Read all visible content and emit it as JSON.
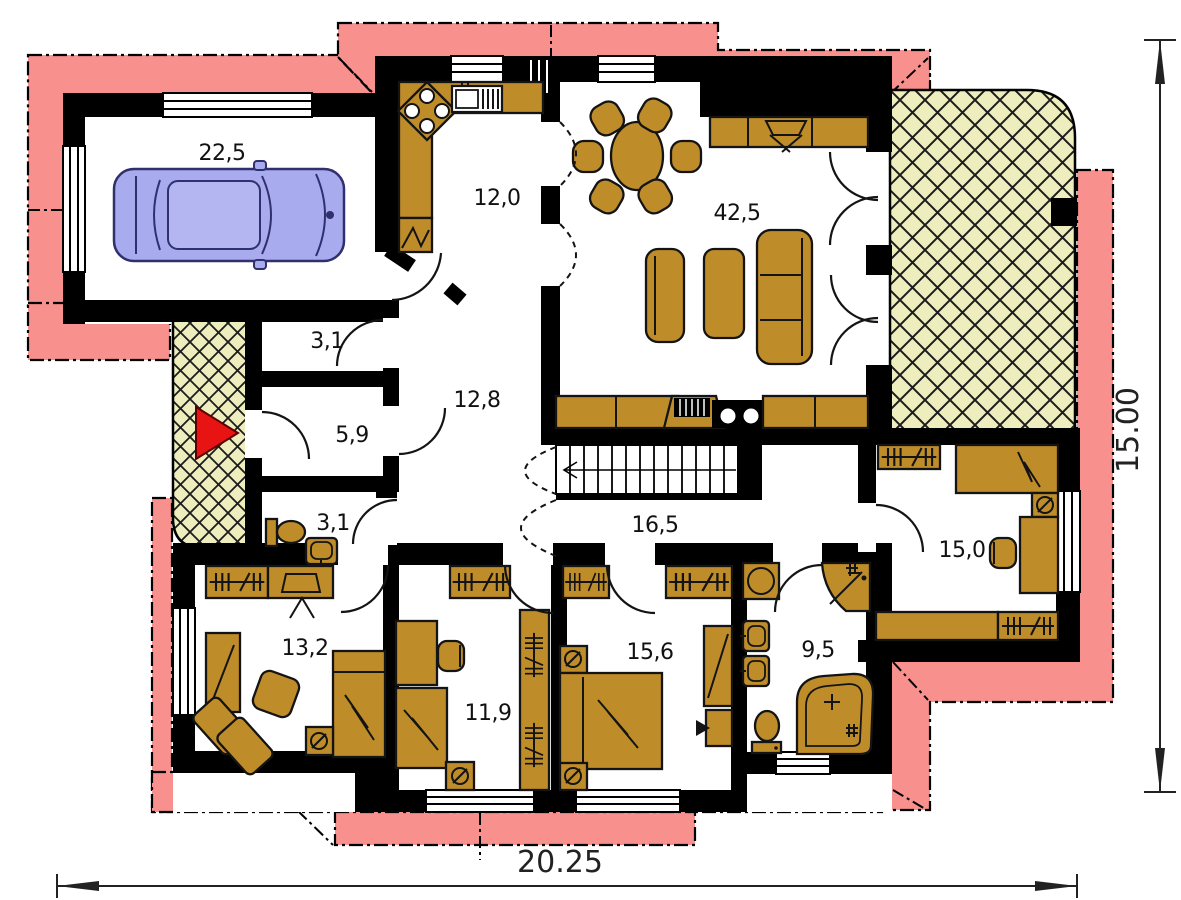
{
  "plan": {
    "type": "floor-plan",
    "rooms": {
      "garage": "22,5",
      "kitchen": "12,0",
      "living_dining": "42,5",
      "pantry": "3,1",
      "entry_hall": "5,9",
      "hall": "12,8",
      "wc": "3,1",
      "corridor": "16,5",
      "bedroom_right": "15,0",
      "study": "13,2",
      "bedroom_small": "11,9",
      "bedroom_master": "15,6",
      "bathroom": "9,5"
    },
    "dimensions": {
      "width": "20.25",
      "height": "15.00"
    },
    "colors": {
      "roof_overhang": "#f8908e",
      "terrace": "#ededbe",
      "furniture": "#bf8c2a",
      "car": "#a9abef",
      "entrance_arrow": "#e81313",
      "wall": "#000000"
    }
  }
}
